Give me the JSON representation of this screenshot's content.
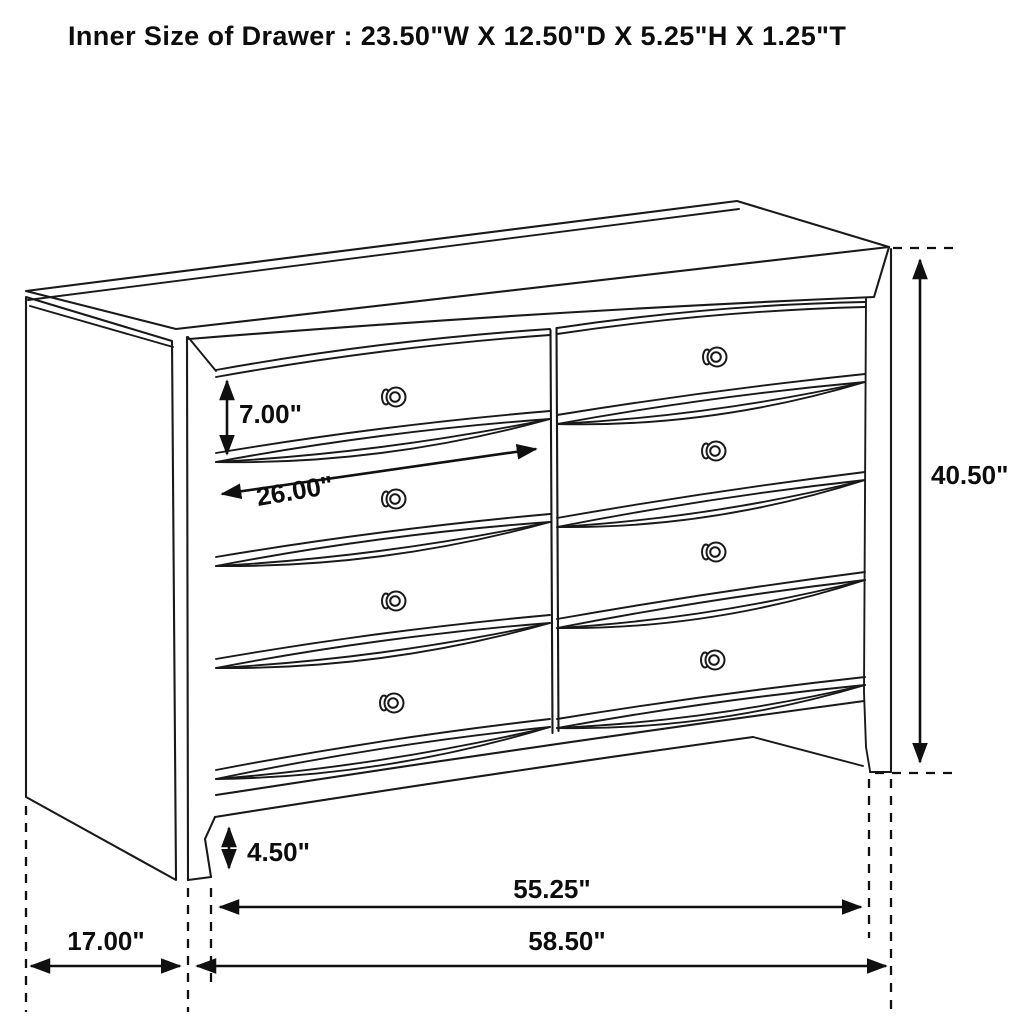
{
  "title": "Inner Size of Drawer : 23.50\"W X 12.50\"D X 5.25\"H X 1.25\"T",
  "diagram": {
    "kind": "dresser-dimension-line-drawing",
    "drawer_count": 8,
    "line_color": "#191919",
    "background_color": "#ffffff"
  },
  "labels": {
    "drawer_opening_height": "7.00\"",
    "drawer_opening_width": "26.00\"",
    "overall_height": "40.50\"",
    "base_height": "4.50\"",
    "width_between_legs": "55.25\"",
    "overall_width": "58.50\"",
    "depth": "17.00\""
  }
}
